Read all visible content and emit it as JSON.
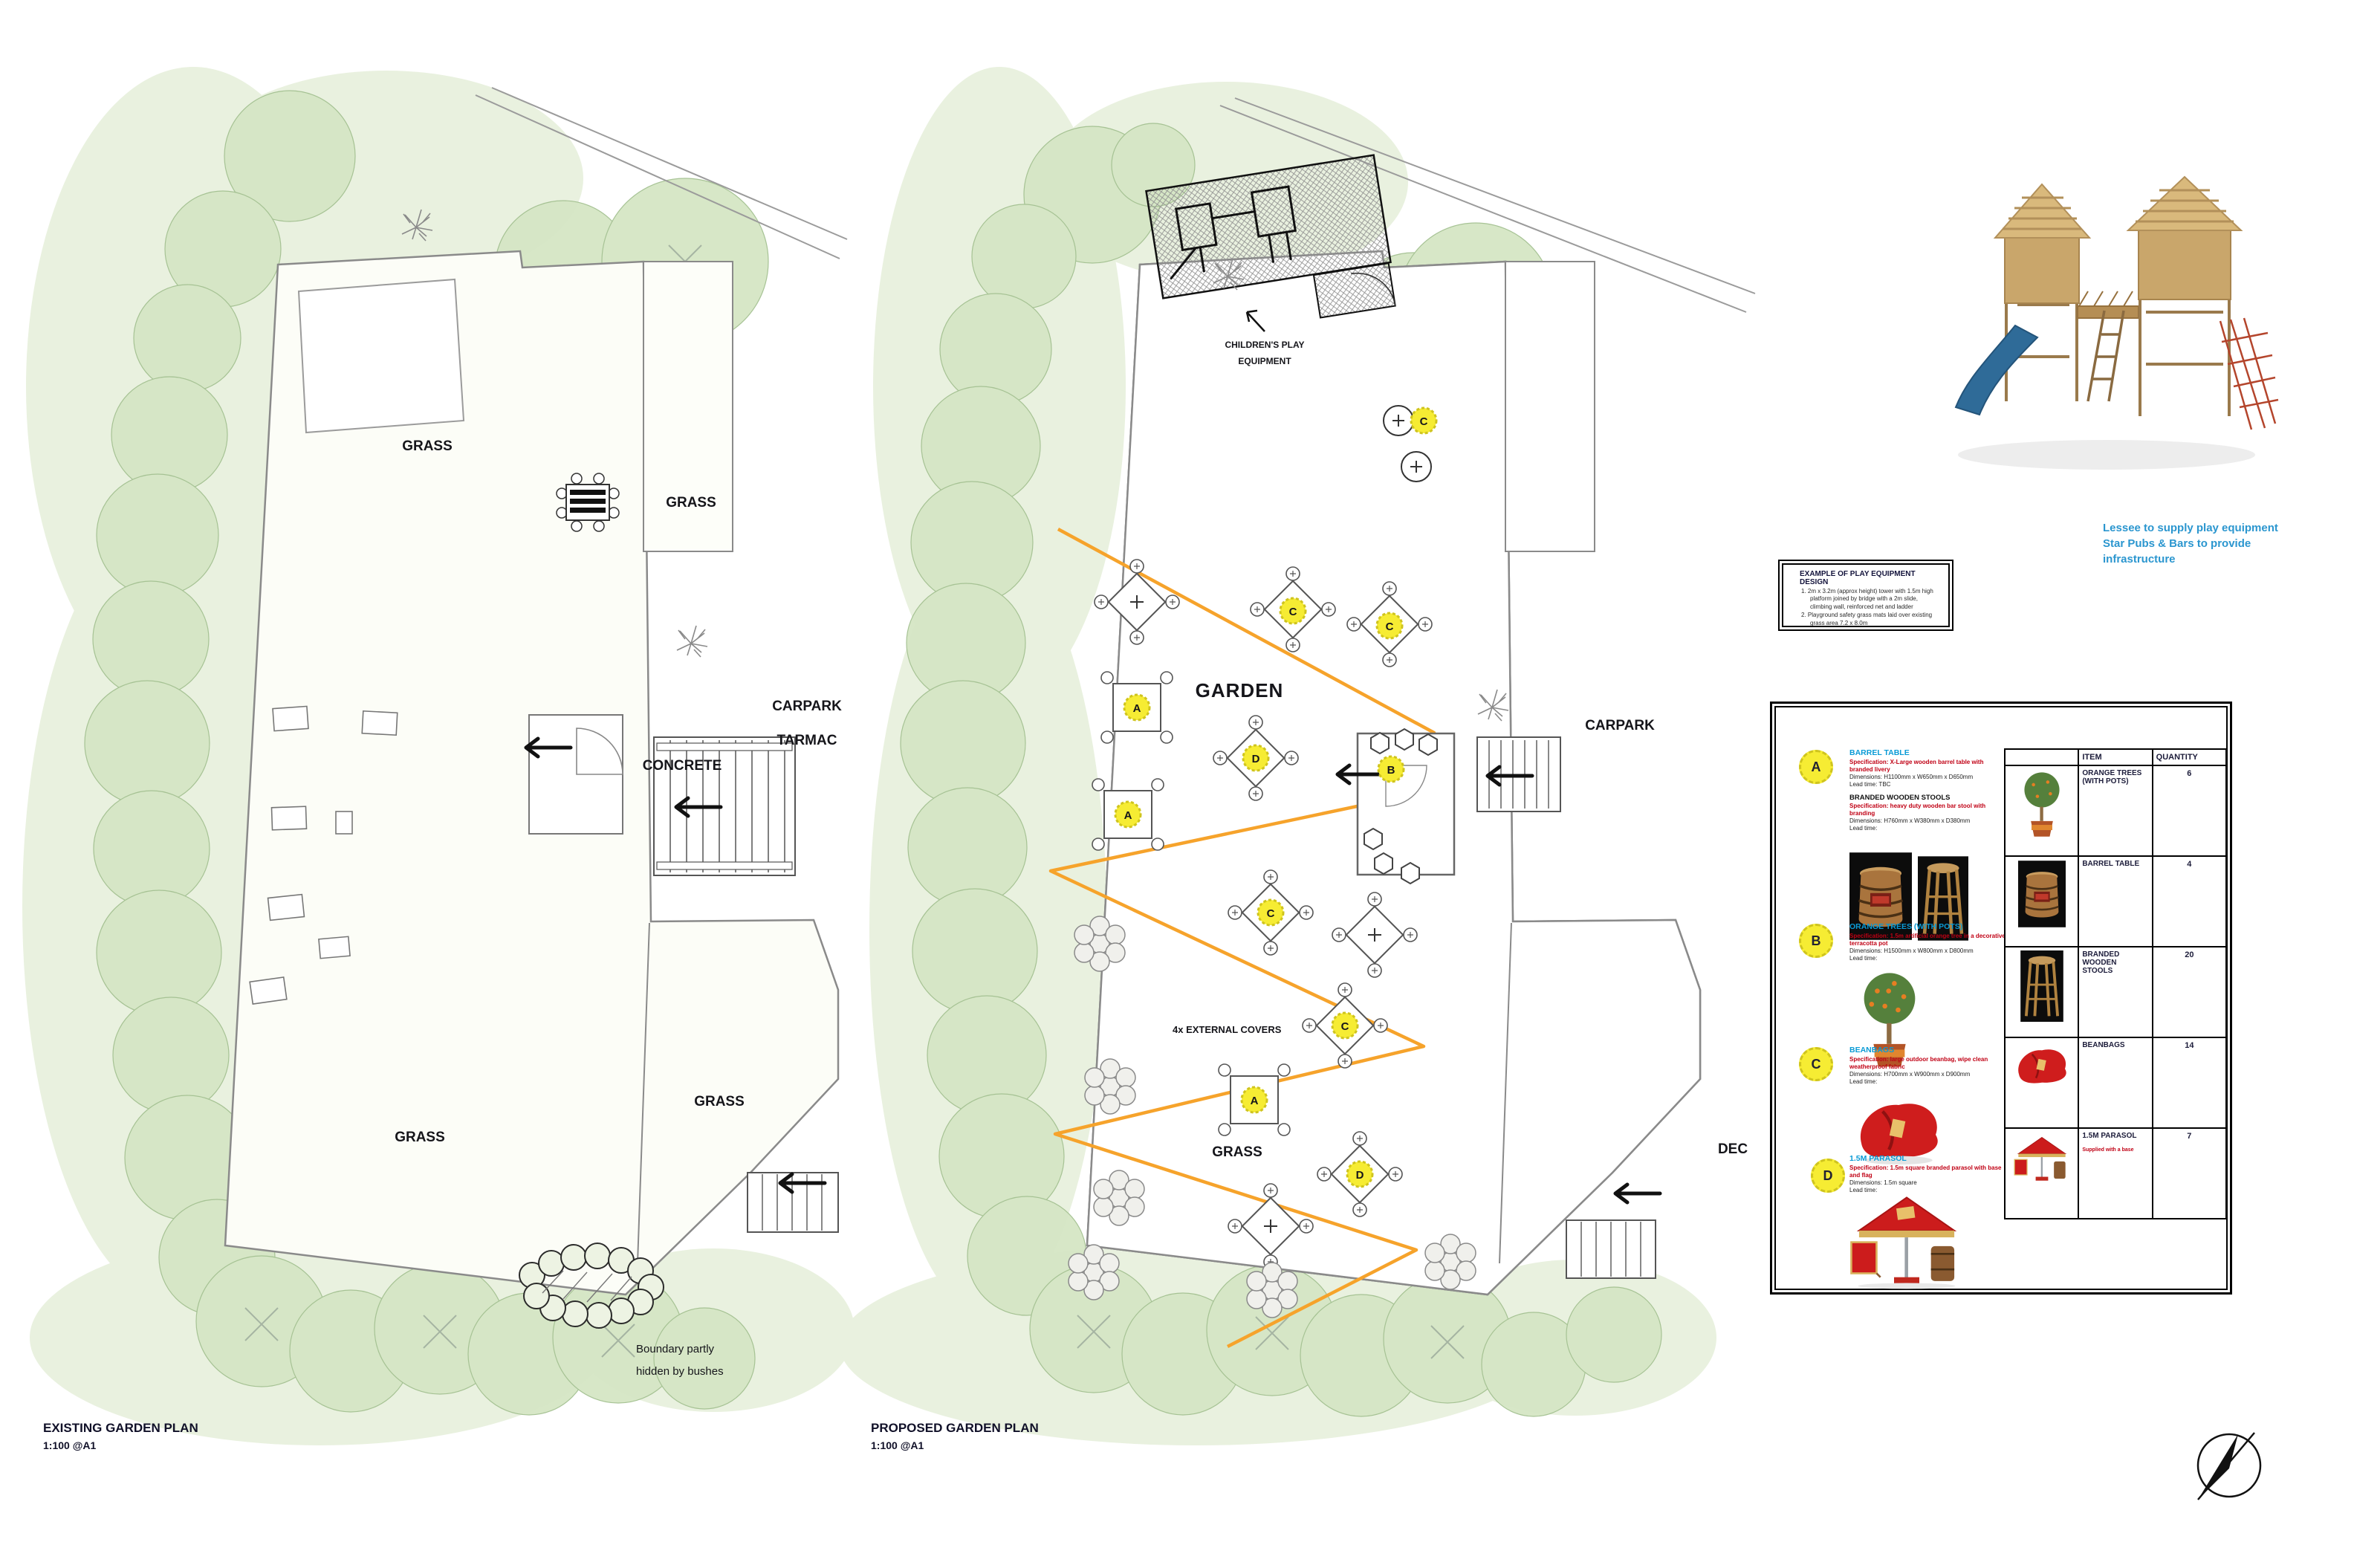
{
  "page": {
    "existing_title": "EXISTING GARDEN PLAN",
    "existing_scale": "1:100 @A1",
    "proposed_title": "PROPOSED GARDEN PLAN",
    "proposed_scale": "1:100 @A1"
  },
  "existing_plan": {
    "labels": {
      "grass_top": "GRASS",
      "grass_strip": "GRASS",
      "carpark": "CARPARK",
      "tarmac": "TARMAC",
      "concrete": "CONCRETE",
      "grass_lower_right": "GRASS",
      "grass_main": "GRASS",
      "boundary_note_1": "Boundary partly",
      "boundary_note_2": "hidden by bushes"
    }
  },
  "proposed_plan": {
    "labels": {
      "play_1": "CHILDREN'S PLAY",
      "play_2": "EQUIPMENT",
      "garden": "GARDEN",
      "carpark": "CARPARK",
      "covers": "4x EXTERNAL COVERS",
      "grass": "GRASS",
      "deck": "DEC"
    },
    "markers": {
      "a": "A",
      "b": "B",
      "c": "C",
      "d": "D"
    }
  },
  "photo_caption": {
    "line1": "Lessee to supply play equipment",
    "line2": "Star Pubs & Bars to provide",
    "line3": "infrastructure"
  },
  "example_box": {
    "title": "EXAMPLE OF PLAY EQUIPMENT DESIGN",
    "item1": "1.  2m x 3.2m (approx height) tower with 1.5m high platform joined by bridge with a 2m slide, climbing wall, reinforced net and ladder",
    "item2": "2.  Playground safety grass mats laid over existing grass area 7.2 x 8.0m"
  },
  "legend": {
    "a": {
      "letter": "A",
      "title": "BARREL TABLE",
      "spec": "Specification: X-Large wooden barrel table with branded livery",
      "dims": "Dimensions: H1100mm x W650mm x D650mm",
      "lead": "Lead time: TBC",
      "sub_title": "BRANDED WOODEN STOOLS",
      "sub_spec": "Specification: heavy duty wooden bar stool with branding",
      "sub_dims": "Dimensions: H760mm x W380mm x D380mm",
      "sub_lead": "Lead time:"
    },
    "b": {
      "letter": "B",
      "title": "ORANGE TREES (WITH POTS)",
      "spec": "Specification: 1.5m artificial orange tree in a decorative terracotta pot",
      "dims": "Dimensions: H1500mm x W800mm x D800mm",
      "lead": "Lead time:"
    },
    "c": {
      "letter": "C",
      "title": "BEANBAGS",
      "spec": "Specification: large outdoor beanbag, wipe clean weatherproof fabric",
      "dims": "Dimensions: H700mm x W900mm x D900mm",
      "lead": "Lead time:"
    },
    "d": {
      "letter": "D",
      "title": "1.5M PARASOL",
      "spec": "Specification: 1.5m square branded parasol with base and flag",
      "dims": "Dimensions: 1.5m square",
      "lead": "Lead time:"
    }
  },
  "schedule_table": {
    "col_item": "ITEM",
    "col_quantity": "QUANTITY",
    "rows": [
      {
        "item": "ORANGE TREES (WITH POTS)",
        "quantity": "6"
      },
      {
        "item": "BARREL TABLE",
        "quantity": "4"
      },
      {
        "item": "BRANDED WOODEN STOOLS",
        "quantity": "20"
      },
      {
        "item": "BEANBAGS",
        "quantity": "14"
      },
      {
        "item": "1.5M PARASOL",
        "quantity": "7",
        "note": "Supplied with a base"
      }
    ]
  }
}
